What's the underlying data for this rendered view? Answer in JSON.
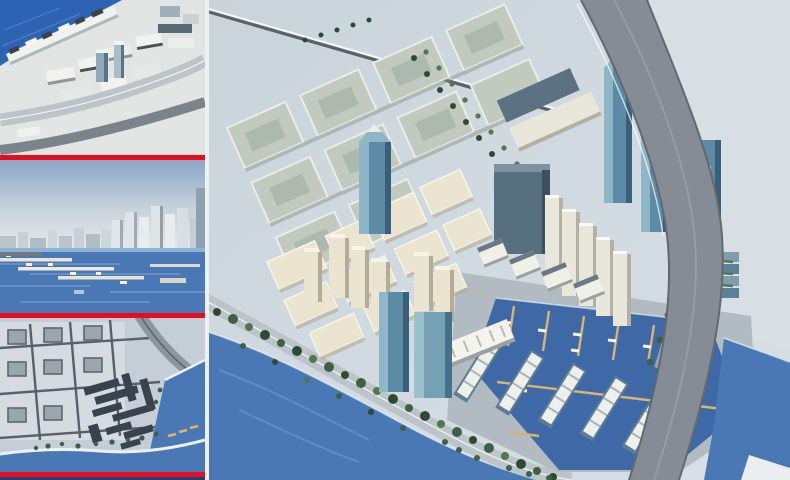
{
  "collage": {
    "description_name": "urban-waterfront-masterplan-render-collage",
    "thumbnails": [
      {
        "name": "aerial-model-photo"
      },
      {
        "name": "waterfront-marina-perspective"
      },
      {
        "name": "site-plan-top-view"
      }
    ],
    "main_view": {
      "name": "masterplan-axonometric-render"
    }
  },
  "colors": {
    "red_divider": "#e60d1d",
    "terrain": "#ccd6dc",
    "terrain_light": "#d7dfe5",
    "water": "#4a78b4",
    "water_light": "#7ba3d4",
    "marina_water": "#3e69a6",
    "deep_water": "#2e63b4",
    "sky_top": "#8ba6c9",
    "sky_mid": "#c8d2da",
    "sky_horizon": "#e3e7e9",
    "sage_wall": "#c2cabf",
    "sage_roof": "#eaece5",
    "sage_inner": "#adb8ae",
    "sage_shadow": "#879188",
    "cream_wall": "#ebe4d0",
    "cream_roof": "#f7f4ea",
    "cream_shadow": "#b3ac96",
    "ivory": "#e9e7db",
    "ivory_side": "#b3b1a4",
    "glass": "#5d8ba6",
    "glass_light": "#8fb6c6",
    "glass_dark": "#38607b",
    "glass_slab": "#57707f",
    "road": "#9aa2a9",
    "road_light": "#bcc3c9",
    "road_dark": "#858c95",
    "road_edge": "#62696f",
    "pier": "#d9b66e",
    "boat_white": "#f6f7f4",
    "tree_dark": "#2e4a33",
    "tree": "#3f6044",
    "tree_light": "#55774f",
    "quay": "#b3bbc2",
    "white_bld": "#f2f2ee",
    "win_dark": "#3c464d",
    "plan_bg": "#c5ced7",
    "plan_light": "#d6dbe1",
    "plan_dark": "#38434f",
    "plan_road": "#8d959e",
    "shore_white": "#edf1f4",
    "navy": "#1e3f78"
  }
}
